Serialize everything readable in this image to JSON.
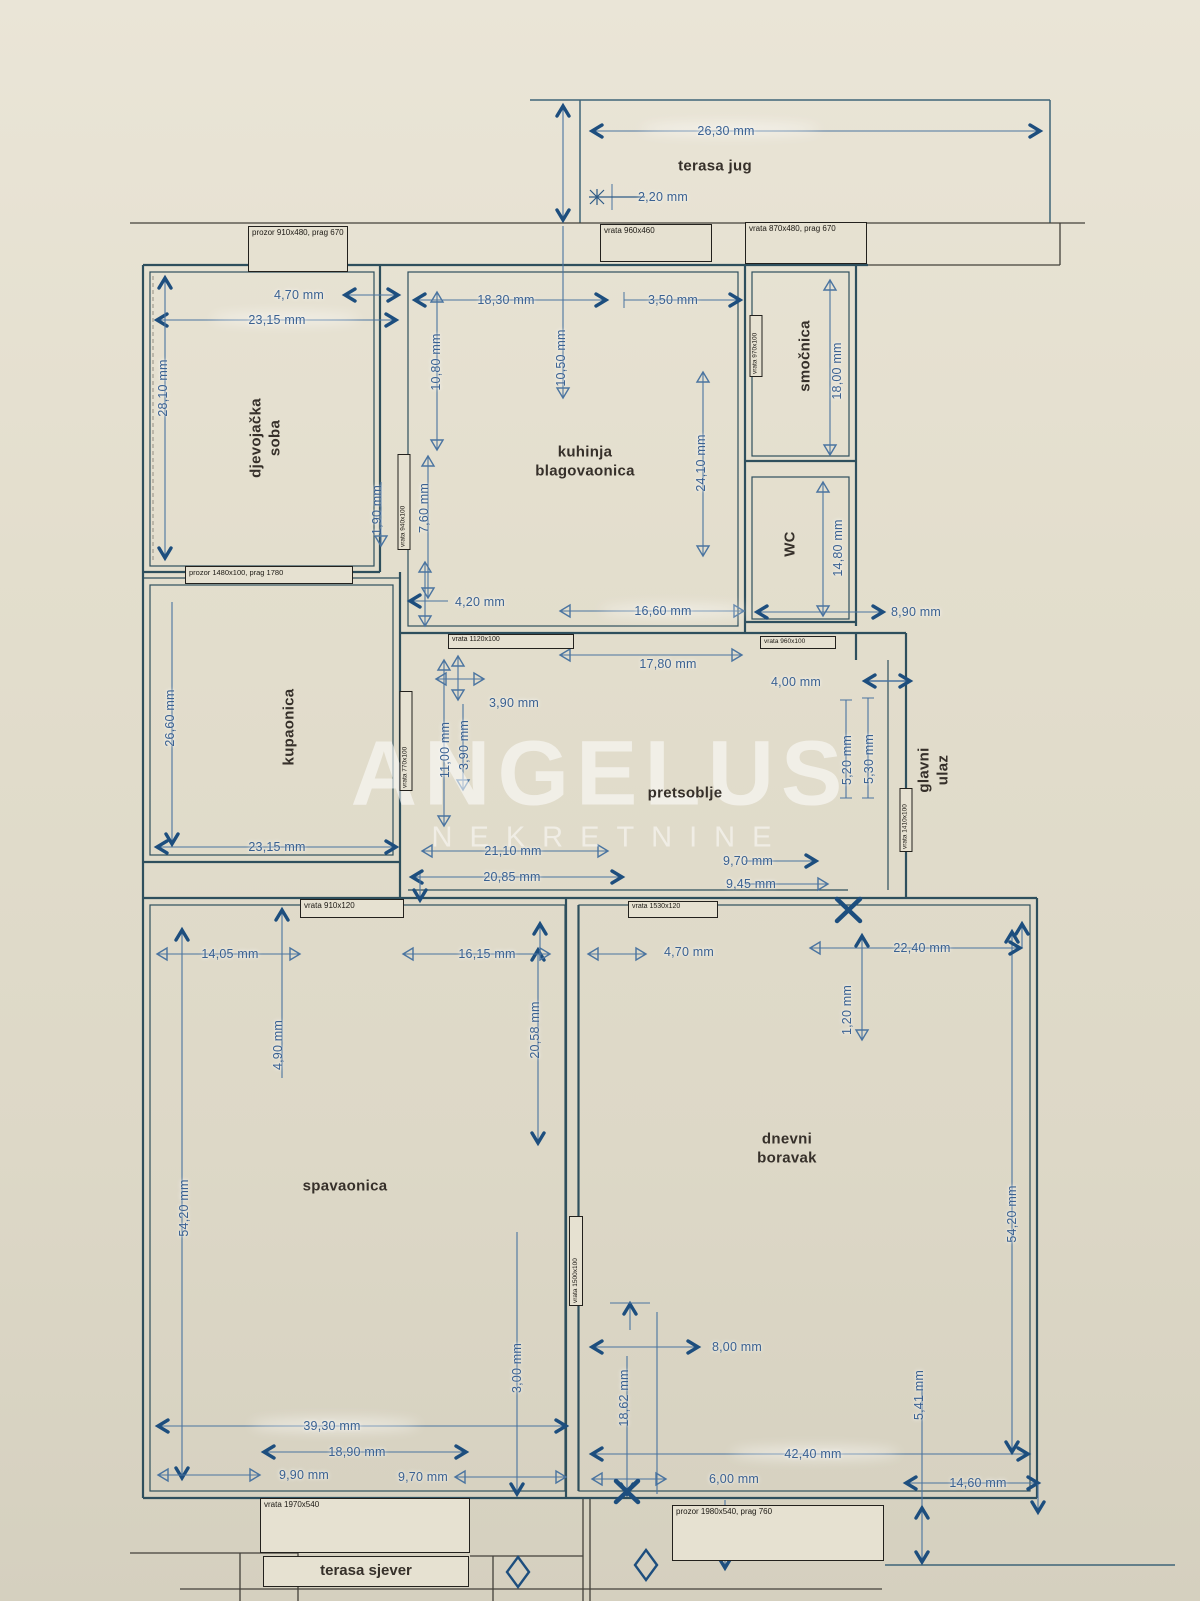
{
  "watermark": {
    "line1": "ANGELUS",
    "line2": "NEKRETNINE"
  },
  "colors": {
    "paper": "#e4dfcf",
    "wall": "#2e4f5d",
    "dim_line": "#4a74a0",
    "bold_arrow": "#1d4e7e",
    "room_text": "#36302a",
    "dim_text": "#3a6191"
  },
  "rooms": {
    "terasa_jug": "terasa jug",
    "djevojacka_soba": "djevojačka soba",
    "kuhinja": "kuhinja blagovaonica",
    "smocnica": "smočnica",
    "wc": "WC",
    "kupaonica": "kupaonica",
    "pretsoblje": "pretsoblje",
    "glavni_ulaz": "glavni ulaz",
    "spavaonica": "spavaonica",
    "dnevni_boravak": "dnevni boravak",
    "terasa_sjever": "terasa sjever"
  },
  "dims": {
    "terasa_jug_sirina": "26,30 mm",
    "terasa_jug_2_20": "2,20 mm",
    "djev_prozor": "4,70 mm",
    "djev_sirina": "23,15 mm",
    "djev_visina": "28,10 mm",
    "djev_1_90": "1,90 mm",
    "kuh_18_30": "18,30 mm",
    "kuh_3_50": "3,50 mm",
    "kuh_10_80": "10,80 mm",
    "kuh_10_50": "10,50 mm",
    "kuh_24_10": "24,10 mm",
    "kuh_7_60": "7,60 mm",
    "kuh_4_20": "4,20 mm",
    "kuh_16_60": "16,60 mm",
    "smocnica_visina": "18,00 mm",
    "wc_visina": "14,80 mm",
    "wc_sirina": "8,90 mm",
    "pret_17_80": "17,80 mm",
    "pret_4_00": "4,00 mm",
    "pret_3_90a": "3,90 mm",
    "pret_3_90b": "3,90 mm",
    "pret_11_00": "11,00 mm",
    "pret_5_20": "5,20 mm",
    "pret_5_30": "5,30 mm",
    "pret_9_70": "9,70 mm",
    "pret_9_45": "9,45 mm",
    "pret_21_10": "21,10 mm",
    "pret_20_85": "20,85 mm",
    "kup_visina": "26,60 mm",
    "kup_sirina": "23,15 mm",
    "spav_14_05": "14,05 mm",
    "spav_16_15": "16,15 mm",
    "spav_4_90": "4,90 mm",
    "spav_20_58": "20,58 mm",
    "spav_54_20": "54,20 mm",
    "spav_3_00": "3,00 mm",
    "spav_39_30": "39,30 mm",
    "spav_18_90": "18,90 mm",
    "spav_9_90": "9,90 mm",
    "spav_9_70": "9,70 mm",
    "dnev_4_70": "4,70 mm",
    "dnev_22_40": "22,40 mm",
    "dnev_1_20": "1,20 mm",
    "dnev_54_20": "54,20 mm",
    "dnev_8_00": "8,00 mm",
    "dnev_18_62": "18,62 mm",
    "dnev_42_40": "42,40 mm",
    "dnev_6_00": "6,00 mm",
    "dnev_5_41": "5,41 mm",
    "dnev_14_60": "14,60 mm"
  },
  "openings": {
    "prozor_910": "prozor 910x480, prag 670",
    "vrata_960_460": "vrata 960x460",
    "vrata_870": "vrata 870x480, prag 670",
    "prozor_1480": "prozor 1480x100, prag 1780",
    "vrata_940": "vrata 940x100",
    "vrata_970": "vrata 970x100",
    "vrata_1120": "vrata 1120x100",
    "vrata_960_100": "vrata 960x100",
    "vrata_770": "vrata 770x100",
    "vrata_1410": "vrata 1410x100",
    "vrata_910_120": "vrata 910x120",
    "vrata_1530": "vrata 1530x120",
    "vrata_1500": "vrata 1500x100",
    "vrata_1970": "vrata 1970x540",
    "prozor_1980": "prozor 1980x540, prag 760"
  }
}
